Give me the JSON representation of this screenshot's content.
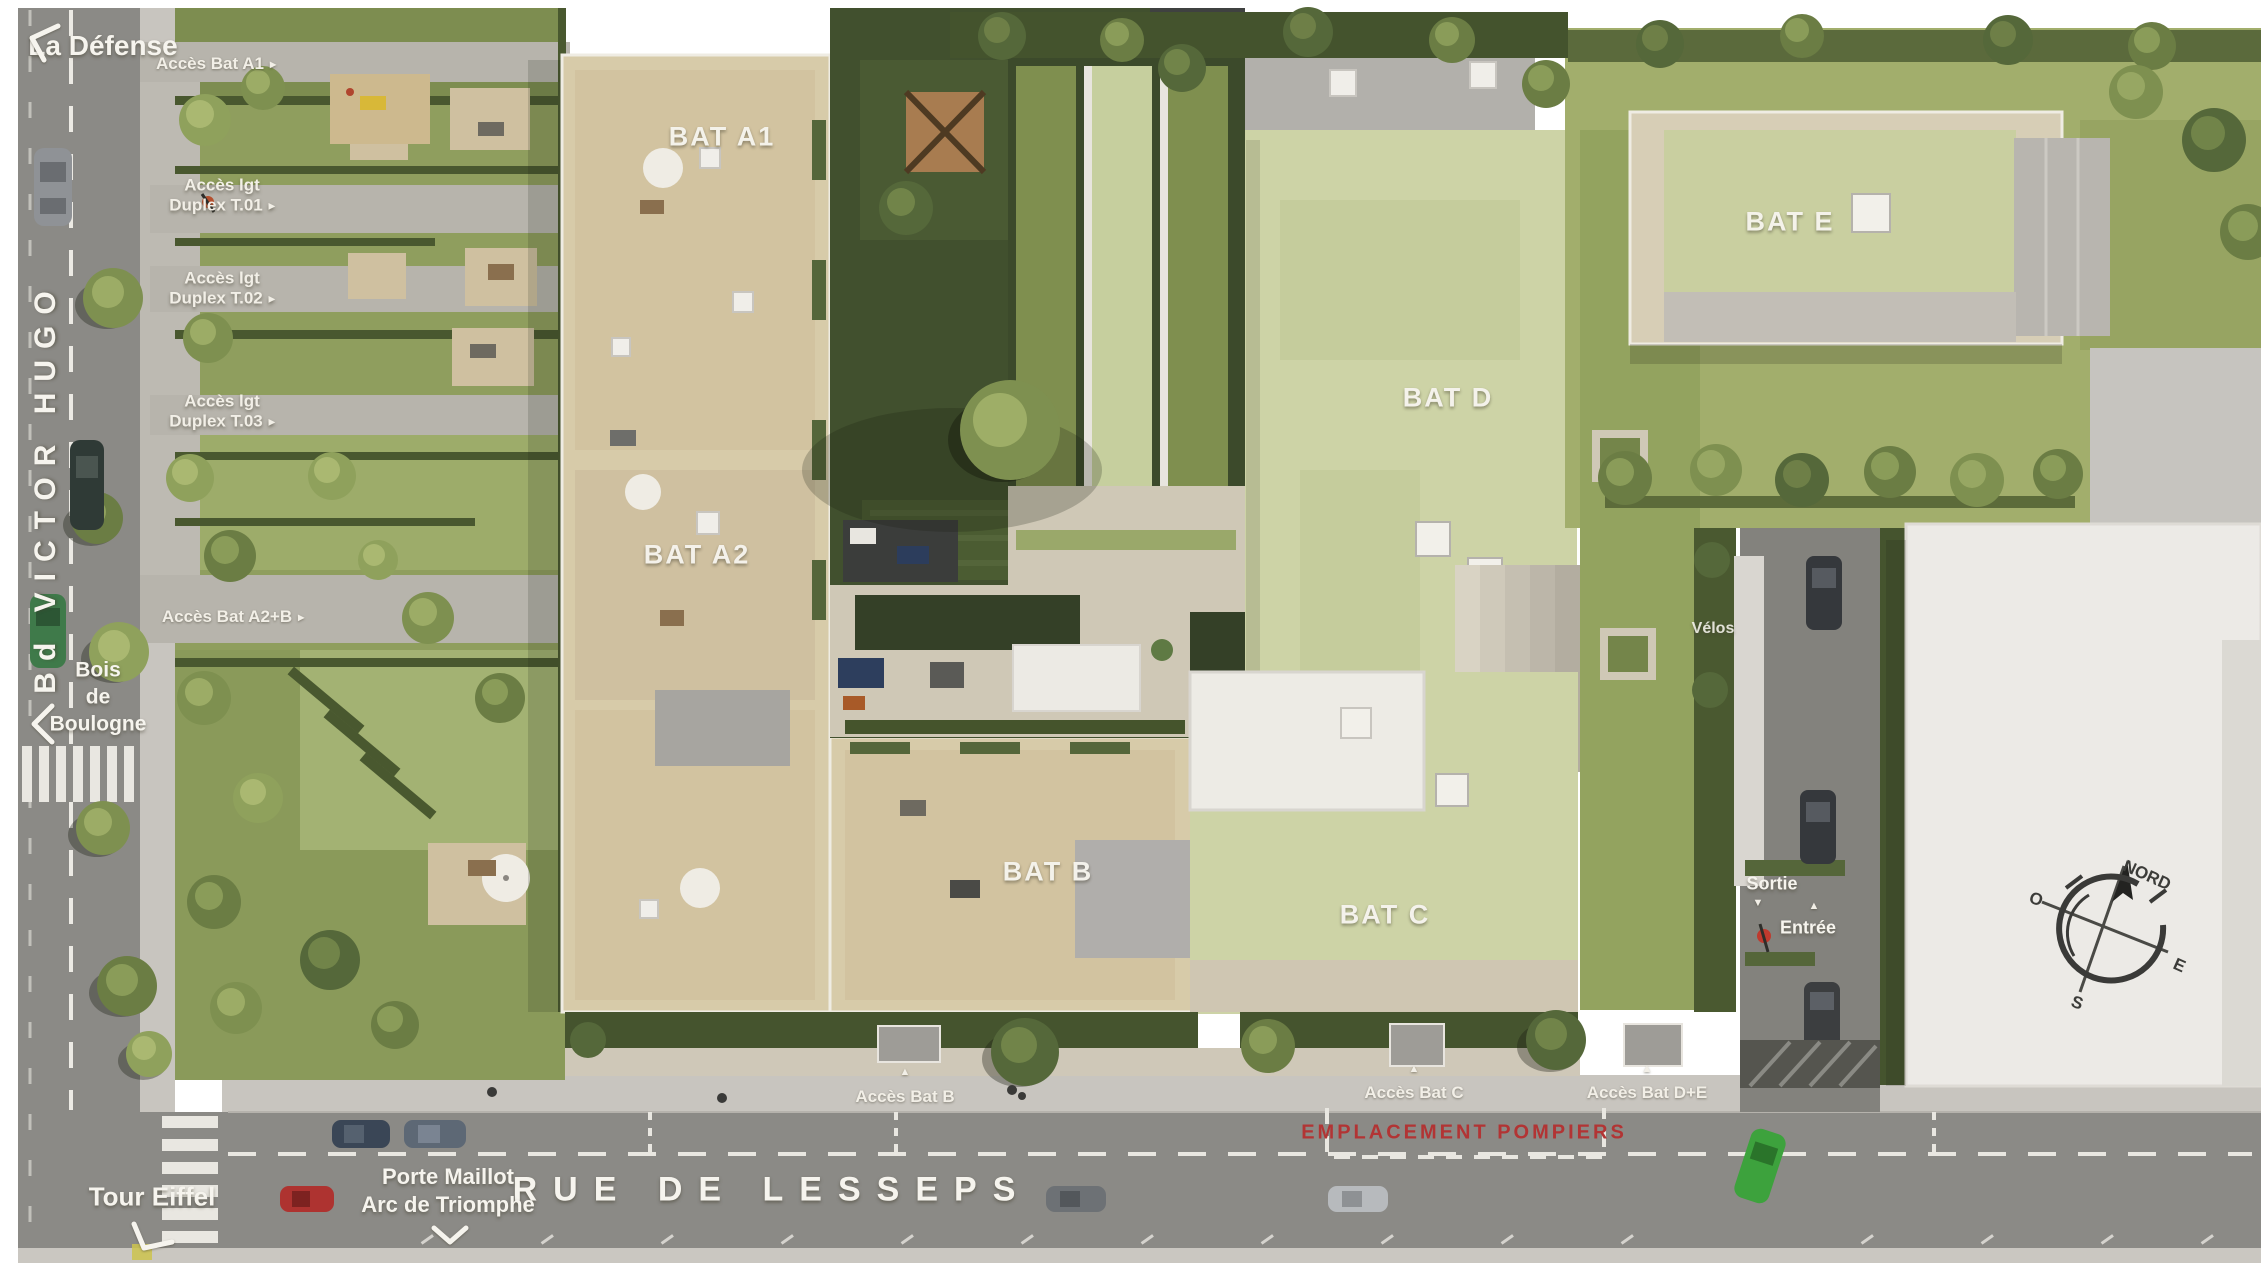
{
  "streets": {
    "victor_hugo": "Bd VICTOR HUGO",
    "lesseps": "RUE DE LESSEPS"
  },
  "directions": {
    "la_defense": "La Défense",
    "tour_eiffel": "Tour Eiffel",
    "bois_line1": "Bois",
    "bois_line2": "de",
    "bois_line3": "Boulogne",
    "porte_maillot": "Porte Maillot",
    "arc_de_triomphe": "Arc de Triomphe"
  },
  "buildings": {
    "a1": "BAT A1",
    "a2": "BAT A2",
    "b": "BAT B",
    "c": "BAT C",
    "d": "BAT D",
    "e": "BAT E"
  },
  "access": {
    "bat_a1": "Accès Bat A1",
    "duplex_t01_line1": "Accès lgt",
    "duplex_t01_line2": "Duplex T.01",
    "duplex_t02_line1": "Accès lgt",
    "duplex_t02_line2": "Duplex T.02",
    "duplex_t03_line1": "Accès lgt",
    "duplex_t03_line2": "Duplex T.03",
    "bat_a2b": "Accès Bat A2+B",
    "bat_b": "Accès Bat B",
    "bat_c": "Accès Bat C",
    "bat_de": "Accès Bat D+E"
  },
  "amenities": {
    "velos": "Vélos",
    "sortie": "Sortie",
    "entree": "Entrée",
    "pompiers": "EMPLACEMENT POMPIERS"
  },
  "compass": {
    "north": "NORD",
    "east": "E",
    "south": "S",
    "west": "O"
  },
  "icons": {
    "arrow_right": "▸",
    "arrow_up": "▲",
    "arrow_down": "▼"
  },
  "colors": {
    "road": "#8b8a86",
    "sidewalk": "#c8c5bf",
    "paving": "#d8d0bc",
    "deck": "#d7cba9",
    "sedum": "#cdd3a6",
    "lawn": "#a2ae6c",
    "hedge": "#45542e",
    "building_white": "#eceae6",
    "label": "#f6f4ee",
    "fire_red": "#b23434"
  }
}
